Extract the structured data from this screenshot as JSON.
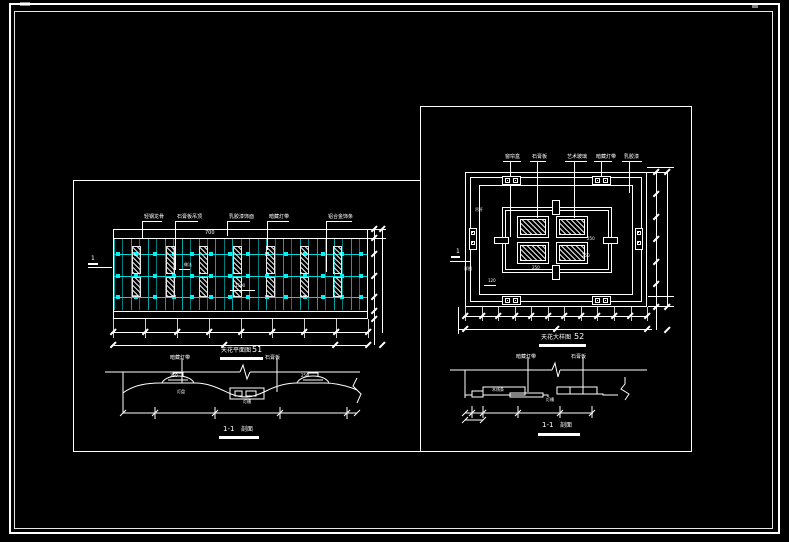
{
  "colors": {
    "background": "#000000",
    "line_white": "#ffffff",
    "grid_vline_dim": "#007d7d",
    "grid_vline": "#00a9a9",
    "grid_hline": "#00d8d8",
    "grid_dot": "#00f2f2"
  },
  "left_panel": {
    "plan": {
      "leader_labels": [
        "轻钢龙骨",
        "石膏板吊顶",
        "乳胶漆饰面",
        "暗藏灯带",
        "铝合金饰条"
      ],
      "top_dim": "700",
      "note_label": "做法",
      "mid_dim": "1500",
      "section_flag": "1",
      "title": "天花平面图",
      "title_num": "51",
      "grid": {
        "rows": 3,
        "vertical_lines": 30,
        "dot_columns": 14,
        "hatch_columns": 7
      }
    },
    "section": {
      "leader_labels": [
        "暗藏灯带",
        "石膏板"
      ],
      "top_dims": [
        "250",
        "250"
      ],
      "box_label": "灯槽",
      "under_dome_label": "灯盘",
      "title": "1-1",
      "title_suffix": "剖面"
    }
  },
  "right_panel": {
    "plan": {
      "leader_labels": [
        "窗帘盒",
        "石膏板",
        "艺术玻璃",
        "暗藏灯带",
        "乳胶漆"
      ],
      "micro_dims": [
        "250",
        "250",
        "250",
        "120"
      ],
      "side_note": "吊杆",
      "note_blob": "详图",
      "section_flag": "1",
      "title": "天花大样图",
      "title_num": "52"
    },
    "section": {
      "leader_labels": [
        "暗藏灯带",
        "石膏板"
      ],
      "step_labels": [
        "木线条",
        "灯槽"
      ],
      "title": "1-1",
      "title_suffix": "剖面"
    }
  }
}
